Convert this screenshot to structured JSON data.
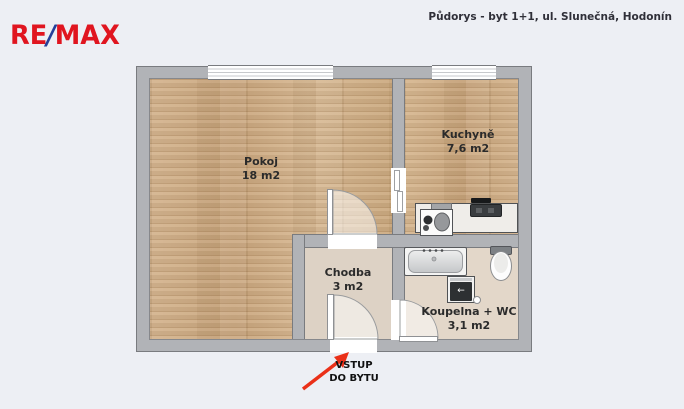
{
  "header": {
    "logo": {
      "re": "RE",
      "slash": "/",
      "max": "MAX"
    },
    "title": "Půdorys - byt 1+1, ul. Slunečná, Hodonín"
  },
  "rooms": [
    {
      "id": "pokoj",
      "name": "Pokoj",
      "area": "18 m2"
    },
    {
      "id": "kuchyne",
      "name": "Kuchyně",
      "area": "7,6 m2"
    },
    {
      "id": "chodba",
      "name": "Chodba",
      "area": "3 m2"
    },
    {
      "id": "koupelna",
      "name": "Koupelna + WC",
      "area": "3,1 m2"
    }
  ],
  "entrance": {
    "label_line1": "VSTUP",
    "label_line2": "DO BYTU"
  },
  "fixtures": {
    "washer_symbol": "←"
  },
  "colors": {
    "background": "#edeff4",
    "wall": "#b1b3b7",
    "wood_floor": "#cfad87",
    "hall_floor": "#ddd2c5",
    "bath_floor": "#e3d7c9",
    "logo_red": "#e0151f",
    "logo_blue": "#26409a",
    "arrow_red": "#ea3018"
  }
}
